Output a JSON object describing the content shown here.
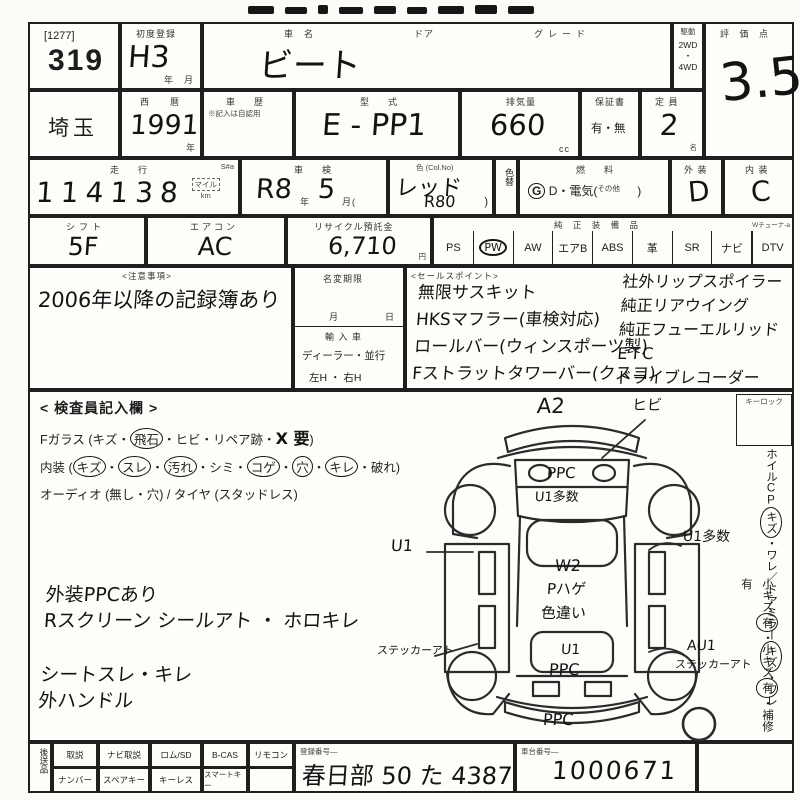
{
  "lot": {
    "bracket": "[1277]",
    "number": "319"
  },
  "first_reg": {
    "label": "初度登録",
    "value": "H3",
    "unit": "年　月"
  },
  "car": {
    "name_label": "車　名",
    "name": "ビート",
    "door_label": "ドア",
    "grade_label": "グレード"
  },
  "drive": {
    "label": "駆動",
    "opt1": "2WD",
    "sep": "・",
    "opt2": "4WD"
  },
  "score": {
    "label": "評 価 点",
    "value": "3.5"
  },
  "row2": {
    "prefecture": "埼玉",
    "year_label": "西　暦",
    "year": "1991",
    "year_unit": "年",
    "history_label": "車　歴",
    "history_note": "※記入は自認用",
    "model_label": "型　式",
    "model": "E - PP1",
    "disp_label": "排気量",
    "disp": "660",
    "disp_unit": "cc",
    "warranty_label": "保証書",
    "warranty": "有・無",
    "capacity_label": "定 員",
    "capacity": "2",
    "capacity_unit": "名"
  },
  "row3": {
    "mileage_label": "走　行",
    "s_mark": "S#a",
    "mileage": "114138",
    "unit_mile": "マイル",
    "unit_km": "km",
    "shaken_label": "車　検",
    "shaken_era": "R8",
    "shaken_era_unit": "年",
    "shaken_month": "5",
    "shaken_month_unit": "月(",
    "color_label": "色 (Col.No)",
    "color": "レッド",
    "color_no": "R80",
    "color_paren": ")",
    "color_change": "色替",
    "fuel_label": "燃　料",
    "fuel_g": "G",
    "fuel_mid": "D・電気(",
    "fuel_other": "その他",
    "fuel_close": ")",
    "ext_label": "外 装",
    "ext": "D",
    "int_label": "内 装",
    "int": "C"
  },
  "row4": {
    "shift_label": "シフト",
    "shift": "5F",
    "ac_label": "エアコン",
    "ac": "AC",
    "recycle_label": "リサイクル預託金",
    "recycle": "6,710",
    "recycle_unit": "円",
    "equip_label": "純 正 装 備 品",
    "equip_note": "Wチューナ-a",
    "equipment": [
      "PS",
      "PW",
      "AW",
      "エアB",
      "ABS",
      "革",
      "SR",
      "ナビ",
      "DTV"
    ]
  },
  "notes": {
    "label": "<注意事項>",
    "text": "2006年以降の記録簿あり"
  },
  "name_change": {
    "label": "名変期限",
    "month": "月",
    "day": "日",
    "import_label": "輸 入 車",
    "import_opts": "ディーラー・並行",
    "handle_opts": "左H ・ 右H"
  },
  "sales": {
    "label": "<セールスポイント>",
    "left": [
      "無限サスキット",
      "HKSマフラー(車検対応)",
      "ロールバー(ウィンスポーツ製)",
      "Fストラットタワーバー(クスコ)"
    ],
    "right": [
      "社外リップスポイラー",
      "純正リアウイング",
      "純正フューエルリッド",
      "ETC",
      "ドライブレコーダー"
    ]
  },
  "inspector": {
    "title": "< 検査員記入欄 >",
    "glass_pre": "Fガラス (キズ・",
    "glass_c1": "飛石",
    "glass_mid": "・ヒビ・リペア跡・",
    "glass_hand": "X 要",
    "glass_post": ")",
    "int_pre": "内装 (",
    "c_kizu": "キズ",
    "d1": "・",
    "c_sure": "スレ",
    "d2": "・",
    "c_yogore": "汚れ",
    "d3": "・シミ・",
    "c_koge": "コゲ",
    "d4": "・",
    "c_ana": "穴",
    "d5": "・",
    "c_kire": "キレ",
    "d6": "・破れ)",
    "audio_line": "オーディオ (無し・穴) / タイヤ (スタッドレス)"
  },
  "hand_notes": [
    "外装PPCあり",
    "Rスクリーン シールアト ・ ホロキレ",
    "シートスレ・キレ",
    "外ハンドル"
  ],
  "diagram": {
    "a2": "A2",
    "hibi": "ヒビ",
    "hood1": "PPC",
    "hood2": "U1多数",
    "left_u1": "U1",
    "right_u1": "U1多数",
    "roof1": "W2",
    "roof2": "Pハゲ",
    "roof3": "色違い",
    "sticker_left": "ステッカーアト",
    "trunk1": "U1",
    "trunk2": "PPC",
    "right_au1": "AU1",
    "sticker_right": "ステッカーアト",
    "bottom_ppc": "PPC"
  },
  "sidebar": {
    "keylock": "キーロック",
    "v1_a": "ホイルCP",
    "v1_c1": "キズ",
    "v1_b": "・ワレ／ドアミラー",
    "v1_c2": "キズ",
    "v1_c": "・ワレ",
    "v2_a": "小キズ",
    "v2_c1": "有",
    "v2_b": "・小キズ",
    "v2_c2": "有",
    "v2_c": "・補修有"
  },
  "bottom": {
    "label": "後送品",
    "row1": [
      "取説",
      "ナビ取説",
      "ロム/SD",
      "B-CAS",
      "リモコン"
    ],
    "row2": [
      "ナンバー",
      "スペアキー",
      "キーレス",
      "スマートキー",
      ""
    ],
    "reg_label": "登録番号―",
    "reg": "春日部 50 た 4387",
    "chassis_label": "車台番号―",
    "chassis": "1000671"
  }
}
